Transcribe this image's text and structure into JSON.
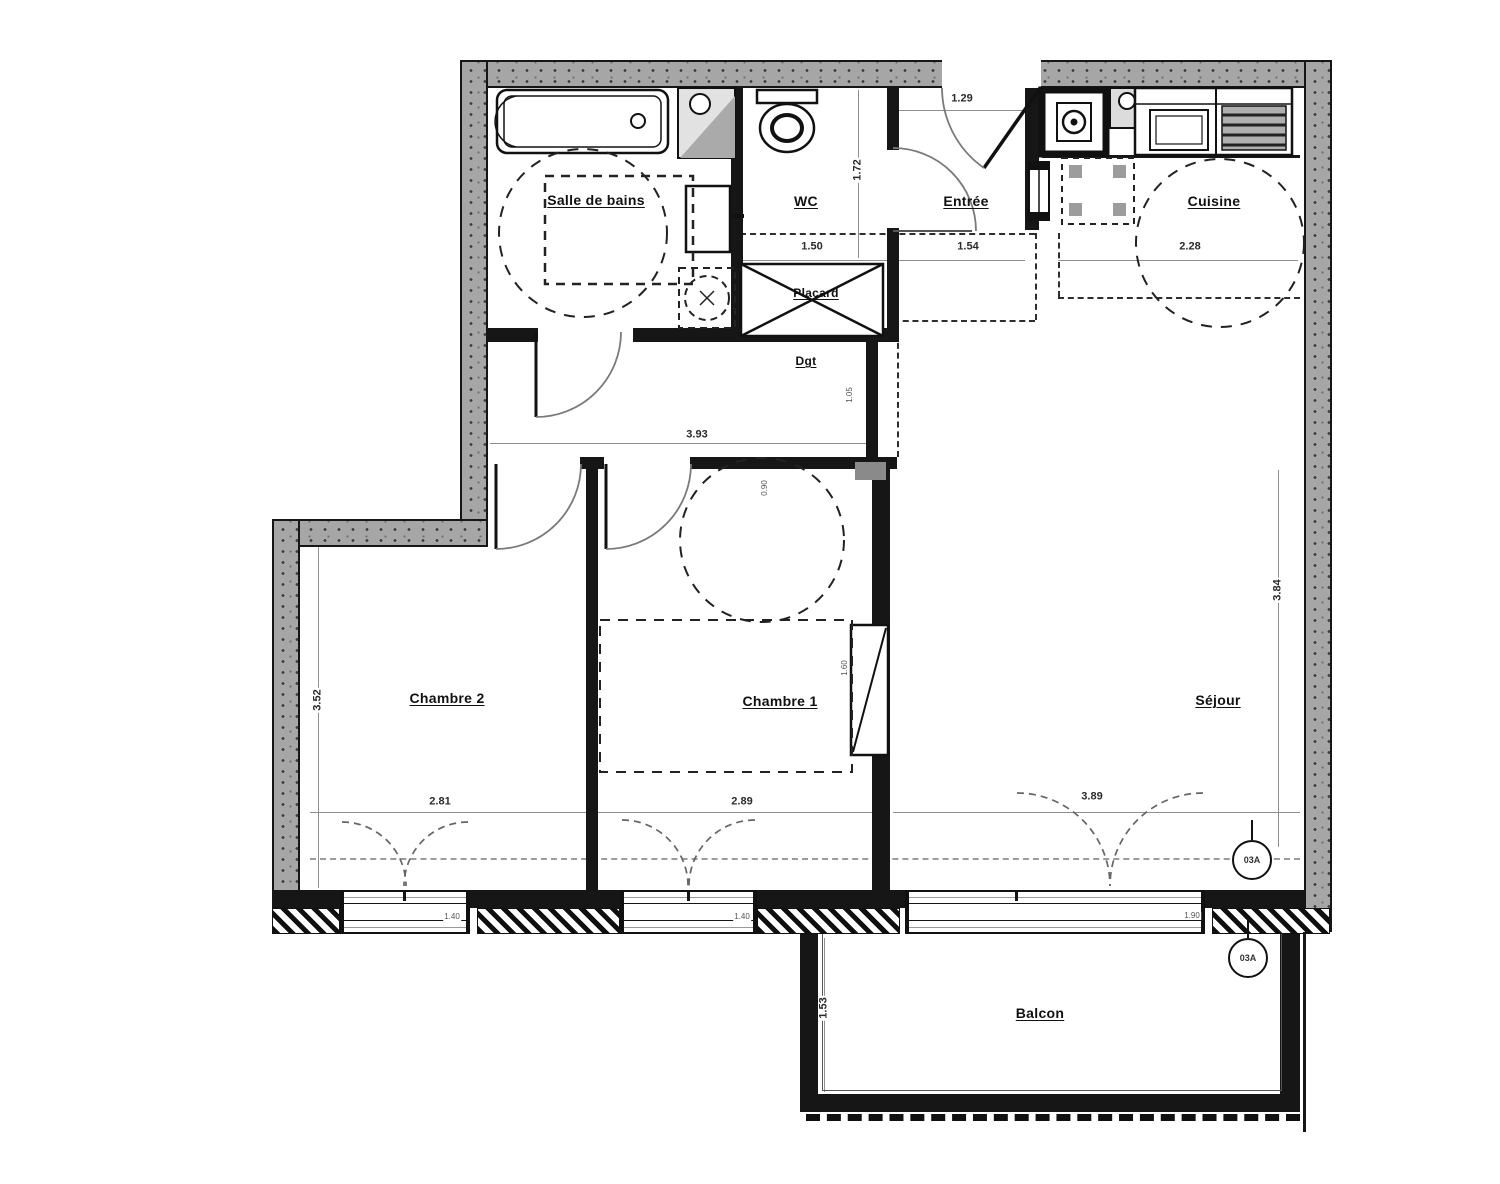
{
  "rooms": {
    "salle_de_bains": "Salle de bains",
    "wc": "WC",
    "entree": "Entrée",
    "cuisine": "Cuisine",
    "placard": "Placard",
    "degagement": "Dgt",
    "chambre2": "Chambre 2",
    "chambre1": "Chambre 1",
    "sejour": "Séjour",
    "balcon": "Balcon"
  },
  "dims": {
    "entree_top": "1.29",
    "wc_width": "1.50",
    "entree_width": "1.54",
    "cuisine_width": "2.28",
    "wc_depth": "1.72",
    "dgt_length": "3.93",
    "dgt_width": "1.05",
    "chambre2_width": "2.81",
    "chambre1_width": "2.89",
    "sejour_width": "3.89",
    "sejour_depth": "3.84",
    "chambre2_depth": "3.52",
    "balcon_depth": "1.53",
    "chambre1_door": "0.90",
    "chambre1_closet": "1.60",
    "window_chambre2": "1.40",
    "window_chambre1": "1.40",
    "sejour_door": "1.90"
  },
  "markers": {
    "sejour": "03A",
    "balcon": "03A"
  },
  "colors": {
    "wall": "#161616",
    "exterior_wall": "#a6a6a6",
    "dimension_line": "#8f8f8f",
    "label": "#111111"
  }
}
